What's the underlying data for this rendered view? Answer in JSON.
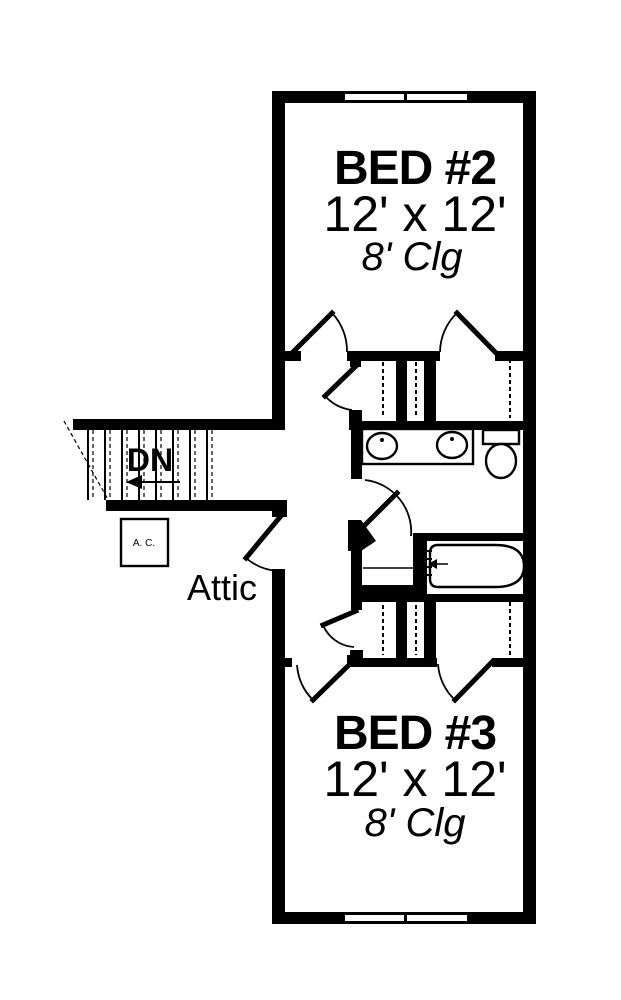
{
  "plan": {
    "title": "second-floor-plan",
    "rooms": {
      "bed2": {
        "name": "BED #2",
        "dimensions": "12' x 12'",
        "ceiling": "8' Clg"
      },
      "bed3": {
        "name": "BED #3",
        "dimensions": "12' x 12'",
        "ceiling": "8' Clg"
      }
    },
    "labels": {
      "stairs_direction": "DN",
      "attic": "Attic",
      "ac_unit": "A. C."
    },
    "colors": {
      "wall": "#000000",
      "background": "#ffffff"
    }
  }
}
